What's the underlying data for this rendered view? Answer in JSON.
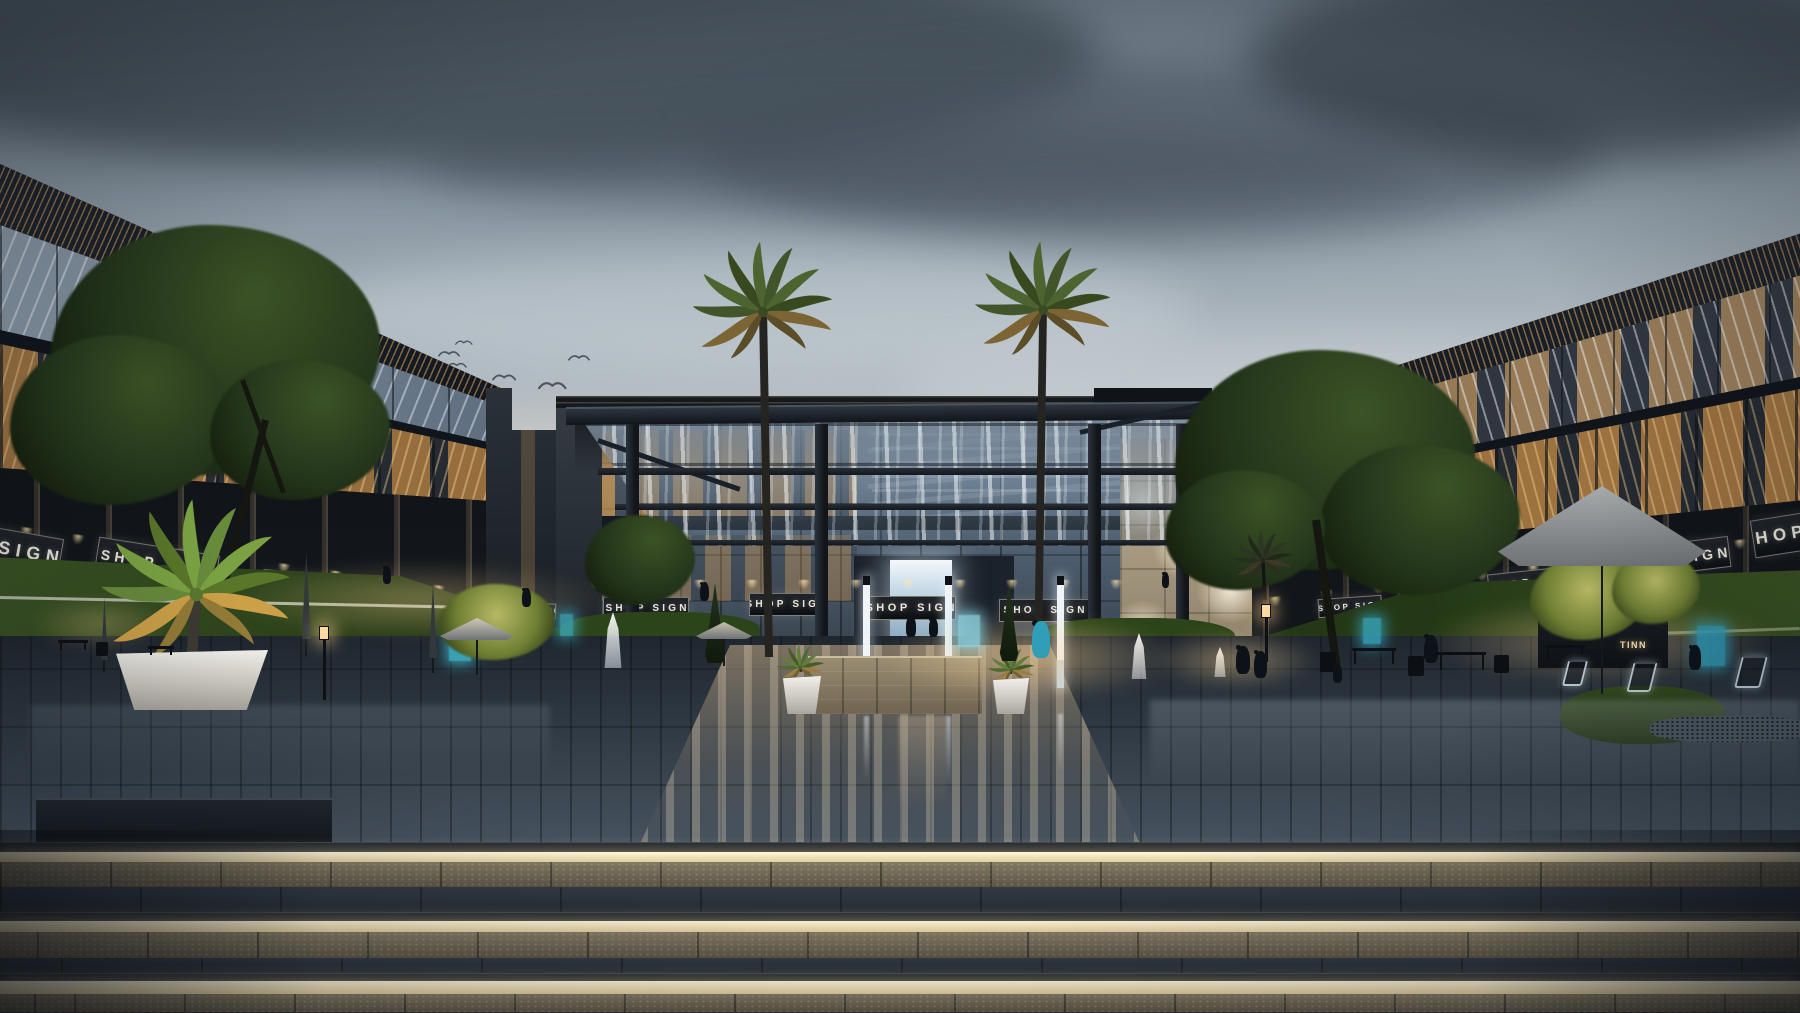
{
  "meta": {
    "title": "Commercial plaza exterior rendering at dusk",
    "width": 1800,
    "height": 1013
  },
  "labels": {
    "shop_sign": "SHOP SIGN",
    "corner_sign": "S-TN",
    "cafe_sign": "TINN"
  },
  "palette": {
    "sky_top": "#5f6b76",
    "sky_horizon": "#d8d2c9",
    "cloud_dark": "#3a444e",
    "building_dark": "#11151a",
    "louver_bronze": "#ac8656",
    "glass_blue": "#8a98a6",
    "interior_warm": "#ce9042",
    "grass": "#32481f",
    "paving": "#2e3842",
    "step_led": "#fff6da",
    "step_stone": "#6d6452",
    "stone_wall": "#c2b49a",
    "planter_white": "#f1efe9",
    "accent_cyan": "#3fb6cc",
    "door_glow": "#f4f8fb"
  },
  "signs": [
    {
      "x": -88,
      "y": 526,
      "w": 150,
      "h": 38,
      "fs": 18,
      "rot": 10,
      "label": "SHOP SIGN"
    },
    {
      "x": 96,
      "y": 546,
      "w": 122,
      "h": 34,
      "fs": 14,
      "rot": 9,
      "label": "SHOP SIGN"
    },
    {
      "x": 262,
      "y": 573,
      "w": 80,
      "h": 25,
      "fs": 10,
      "rot": 6,
      "label": "SHOP SIGN"
    },
    {
      "x": 367,
      "y": 588,
      "w": 62,
      "h": 20,
      "fs": 8,
      "rot": 5,
      "label": "SHOP SIGN"
    },
    {
      "x": 459,
      "y": 597,
      "w": 52,
      "h": 17,
      "fs": 7,
      "rot": 4,
      "label": "SHOP SIGN"
    },
    {
      "x": 512,
      "y": 603,
      "w": 44,
      "h": 15,
      "fs": 6,
      "rot": 2,
      "label": "SHOP SIGN"
    },
    {
      "x": 603,
      "y": 597,
      "w": 86,
      "h": 23,
      "fs": 10,
      "rot": 0,
      "label": "SHOP SIGN"
    },
    {
      "x": 749,
      "y": 593,
      "w": 74,
      "h": 23,
      "fs": 10,
      "rot": 0,
      "label": "SHOP SIGN"
    },
    {
      "x": 864,
      "y": 596,
      "w": 92,
      "h": 24,
      "fs": 11,
      "rot": 0,
      "label": "SHOP SIGN"
    },
    {
      "x": 999,
      "y": 599,
      "w": 90,
      "h": 23,
      "fs": 10,
      "rot": 0,
      "label": "SHOP SIGN"
    },
    {
      "x": 1318,
      "y": 597,
      "w": 64,
      "h": 19,
      "fs": 8,
      "rot": -4,
      "label": "SHOP SIGN"
    },
    {
      "x": 1399,
      "y": 588,
      "w": 70,
      "h": 21,
      "fs": 9,
      "rot": -5,
      "label": "SHOP SIGN"
    },
    {
      "x": 1488,
      "y": 570,
      "w": 88,
      "h": 25,
      "fs": 11,
      "rot": -6,
      "label": "SHOP SIGN"
    },
    {
      "x": 1612,
      "y": 543,
      "w": 118,
      "h": 31,
      "fs": 14,
      "rot": -7,
      "label": "SHOP SIGN"
    },
    {
      "x": 1752,
      "y": 512,
      "w": 110,
      "h": 38,
      "fs": 17,
      "rot": -9,
      "label": "SHOP SIGN"
    }
  ],
  "birds": [
    {
      "x": 438,
      "y": 348,
      "s": 1.0
    },
    {
      "x": 455,
      "y": 338,
      "s": 0.8
    },
    {
      "x": 447,
      "y": 360,
      "s": 0.9
    },
    {
      "x": 492,
      "y": 371,
      "s": 1.1
    },
    {
      "x": 538,
      "y": 378,
      "s": 1.3
    },
    {
      "x": 568,
      "y": 352,
      "s": 1.0
    }
  ],
  "people": [
    {
      "x": 383,
      "y": 566,
      "h": 24
    },
    {
      "x": 522,
      "y": 588,
      "h": 26
    },
    {
      "x": 700,
      "y": 582,
      "h": 26
    },
    {
      "x": 906,
      "y": 616,
      "h": 28
    },
    {
      "x": 929,
      "y": 618,
      "h": 26
    },
    {
      "x": 1032,
      "y": 620,
      "h": 52,
      "c": "#2f9eb6"
    },
    {
      "x": 1236,
      "y": 645,
      "h": 40
    },
    {
      "x": 1254,
      "y": 650,
      "h": 38
    },
    {
      "x": 1424,
      "y": 634,
      "h": 40
    },
    {
      "x": 1333,
      "y": 664,
      "h": 26
    },
    {
      "x": 1689,
      "y": 645,
      "h": 34
    },
    {
      "x": 1162,
      "y": 572,
      "h": 22
    }
  ],
  "palms": [
    {
      "x": 763,
      "y": 312,
      "s": 1.0,
      "trunk": 345,
      "lean": 6,
      "cls": "palm-dark"
    },
    {
      "x": 1043,
      "y": 310,
      "s": 0.97,
      "trunk": 340,
      "lean": -5,
      "cls": "palm-dark"
    },
    {
      "x": 1263,
      "y": 560,
      "s": 0.42,
      "trunk": 95,
      "lean": 5,
      "cls": "palm-dim"
    },
    {
      "x": 196,
      "y": 594,
      "s": 1.35,
      "trunk": 58,
      "lean": -4,
      "cls": "palm-bright"
    },
    {
      "x": 800,
      "y": 668,
      "s": 0.34,
      "trunk": 12,
      "lean": 2,
      "cls": "palm-mid"
    },
    {
      "x": 1011,
      "y": 670,
      "s": 0.33,
      "trunk": 12,
      "lean": -2,
      "cls": "palm-mid"
    }
  ],
  "trees": [
    {
      "c": "dark",
      "blobs": [
        {
          "cx": 215,
          "cy": 350,
          "rx": 165,
          "ry": 125
        },
        {
          "cx": 120,
          "cy": 420,
          "rx": 110,
          "ry": 85
        },
        {
          "cx": 300,
          "cy": 430,
          "rx": 90,
          "ry": 70
        }
      ]
    },
    {
      "c": "dark",
      "blobs": [
        {
          "cx": 1325,
          "cy": 460,
          "rx": 150,
          "ry": 110
        },
        {
          "cx": 1420,
          "cy": 520,
          "rx": 100,
          "ry": 75
        },
        {
          "cx": 1245,
          "cy": 530,
          "rx": 80,
          "ry": 60
        }
      ]
    },
    {
      "c": "lit",
      "blobs": [
        {
          "cx": 1588,
          "cy": 598,
          "rx": 58,
          "ry": 42
        },
        {
          "cx": 1656,
          "cy": 588,
          "rx": 44,
          "ry": 36
        }
      ]
    },
    {
      "c": "lit",
      "blobs": [
        {
          "cx": 497,
          "cy": 622,
          "rx": 58,
          "ry": 38
        }
      ]
    },
    {
      "c": "dark",
      "blobs": [
        {
          "cx": 640,
          "cy": 560,
          "rx": 55,
          "ry": 45
        }
      ]
    }
  ],
  "cones": [
    {
      "x": 702,
      "y": 583,
      "w": 26,
      "h": 80
    },
    {
      "x": 997,
      "y": 585,
      "w": 24,
      "h": 76
    }
  ],
  "planters": [
    {
      "x": 783,
      "y": 676,
      "w": 38,
      "h": 38
    },
    {
      "x": 993,
      "y": 678,
      "w": 36,
      "h": 36
    },
    {
      "x": 116,
      "y": 650,
      "w": 152,
      "h": 60
    }
  ],
  "lamps": [
    {
      "x": 318,
      "y": 626,
      "h": 74
    },
    {
      "x": 1260,
      "y": 604,
      "h": 58
    }
  ],
  "umbrellas_open": [
    {
      "x": 440,
      "y": 618,
      "w": 74,
      "h": 22,
      "c": "#cfc8b8"
    },
    {
      "x": 696,
      "y": 622,
      "w": 56,
      "h": 17,
      "c": "#c6bfae"
    },
    {
      "x": 1498,
      "y": 486,
      "w": 208,
      "h": 80,
      "c": "#a7abac"
    }
  ],
  "umbrellas_closed": [
    {
      "x": 97,
      "y": 598,
      "h": 62
    },
    {
      "x": 296,
      "y": 553,
      "h": 86
    },
    {
      "x": 424,
      "y": 583,
      "h": 75
    }
  ],
  "fountains": [
    {
      "x": 598,
      "y": 612,
      "w": 30,
      "h": 56
    },
    {
      "x": 1126,
      "y": 633,
      "w": 26,
      "h": 46
    },
    {
      "x": 1210,
      "y": 647,
      "w": 20,
      "h": 30
    }
  ],
  "pylons": [
    866,
    948,
    1060
  ],
  "columns": [
    633,
    822,
    1095,
    1183
  ],
  "beams": [
    {
      "x": 598,
      "y": 468,
      "w": 640,
      "h": 7
    },
    {
      "x": 615,
      "y": 504,
      "w": 609,
      "h": 6
    },
    {
      "x": 636,
      "y": 540,
      "w": 574,
      "h": 5
    }
  ],
  "accents": [
    {
      "x": 449,
      "y": 631,
      "w": 22,
      "h": 30,
      "c": "#3fb6cc",
      "o": 0.85
    },
    {
      "x": 560,
      "y": 614,
      "w": 13,
      "h": 22,
      "c": "#3fb6cc",
      "o": 0.7
    },
    {
      "x": 958,
      "y": 615,
      "w": 22,
      "h": 32,
      "c": "#8fd8e6",
      "o": 0.8
    },
    {
      "x": 1363,
      "y": 618,
      "w": 18,
      "h": 26,
      "c": "#37a8c0",
      "o": 0.8
    },
    {
      "x": 1697,
      "y": 626,
      "w": 28,
      "h": 40,
      "c": "#2e9cb8",
      "o": 0.85
    }
  ],
  "glows": [
    {
      "x": 230,
      "y": 560,
      "w": 380,
      "h": 80,
      "o": 0.35
    },
    {
      "x": 880,
      "y": 612,
      "w": 300,
      "h": 90,
      "o": 0.5
    },
    {
      "x": 1420,
      "y": 596,
      "w": 360,
      "h": 90,
      "o": 0.4
    },
    {
      "x": 30,
      "y": 596,
      "w": 140,
      "h": 56,
      "o": 0.3
    },
    {
      "x": 1150,
      "y": 630,
      "w": 170,
      "h": 60,
      "o": 0.45
    }
  ],
  "refl": [
    {
      "x": 864,
      "y": 716,
      "w": 5,
      "h": 64,
      "c": "rgba(235,243,250,.5)"
    },
    {
      "x": 946,
      "y": 716,
      "w": 5,
      "h": 72,
      "c": "rgba(235,243,250,.5)"
    },
    {
      "x": 1058,
      "y": 714,
      "w": 5,
      "h": 58,
      "c": "rgba(235,243,250,.45)"
    },
    {
      "x": 898,
      "y": 716,
      "w": 48,
      "h": 92,
      "c": "rgba(214,190,158,.3)"
    }
  ],
  "steps": [
    {
      "top": 842,
      "led": 852,
      "stone": 862,
      "tread": 887,
      "bottom": 912
    },
    {
      "top": 912,
      "led": 921,
      "stone": 932,
      "tread": 958,
      "bottom": 973
    },
    {
      "top": 973,
      "led": 981,
      "stone": 994,
      "tread": 1012,
      "bottom": 1013
    }
  ],
  "furniture": {
    "tables": [
      {
        "x": 1352,
        "y": 648,
        "w": 44,
        "lg": 16
      },
      {
        "x": 1438,
        "y": 652,
        "w": 48,
        "lg": 18
      },
      {
        "x": 1545,
        "y": 645,
        "w": 40,
        "lg": 14
      },
      {
        "x": 58,
        "y": 640,
        "w": 30,
        "lg": 10
      },
      {
        "x": 148,
        "y": 646,
        "w": 26,
        "lg": 9
      }
    ],
    "chairs": [
      {
        "x": 1320,
        "y": 652,
        "w": 16,
        "h": 20
      },
      {
        "x": 1408,
        "y": 656,
        "w": 16,
        "h": 20
      },
      {
        "x": 1494,
        "y": 655,
        "w": 15,
        "h": 18
      },
      {
        "x": 96,
        "y": 642,
        "w": 12,
        "h": 14
      }
    ],
    "chairs_lit": [
      {
        "x": 1630,
        "y": 662,
        "w": 24,
        "h": 30
      },
      {
        "x": 1738,
        "y": 656,
        "w": 26,
        "h": 32
      },
      {
        "x": 1565,
        "y": 660,
        "w": 20,
        "h": 26
      }
    ]
  },
  "clouds": [
    {
      "x": -150,
      "y": -60,
      "w": 1250,
      "h": 230,
      "c": "rgba(58,68,78,.75)"
    },
    {
      "x": 700,
      "y": 60,
      "w": 900,
      "h": 180,
      "c": "rgba(70,80,92,.6)"
    },
    {
      "x": 1250,
      "y": -40,
      "w": 650,
      "h": 200,
      "c": "rgba(52,62,72,.7)"
    },
    {
      "x": 420,
      "y": 120,
      "w": 1000,
      "h": 90,
      "c": "rgba(66,76,88,.5)"
    },
    {
      "x": 300,
      "y": 250,
      "w": 900,
      "h": 120,
      "c": "rgba(235,240,244,.28)"
    },
    {
      "x": 150,
      "y": 420,
      "w": 700,
      "h": 90,
      "c": "rgba(230,205,190,.30)"
    },
    {
      "x": 900,
      "y": 330,
      "w": 800,
      "h": 110,
      "c": "rgba(228,232,236,.25)"
    }
  ]
}
